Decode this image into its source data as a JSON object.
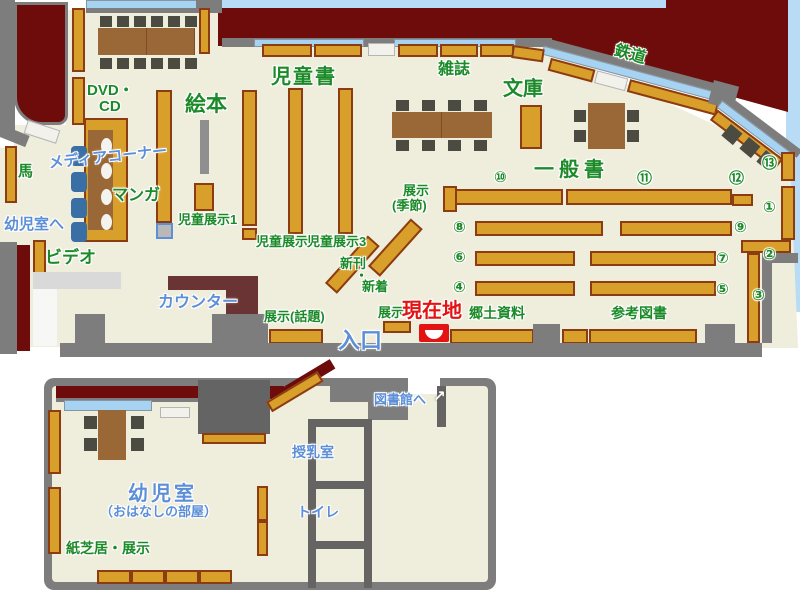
{
  "labels": {
    "dvd1": "DVD・",
    "dvd2": "CD",
    "ehon": "絵本",
    "jidosho": "児童書",
    "zasshi": "雑誌",
    "bunko": "文庫",
    "ippansho": "一般書",
    "tetsudo": "鉄道",
    "media_corner": "メディアコーナー",
    "manga": "マンガ",
    "uma": "馬",
    "yojishitsu_e": "幼児室へ",
    "video": "ビデオ",
    "counter": "カウンター",
    "jido_tenji1": "児童展示1",
    "jido_tenji2": "児童展示2",
    "jido_tenji3": "児童展示3",
    "tenji_kisetsu1": "展示",
    "tenji_kisetsu2": "(季節)",
    "shinkan": "新刊",
    "dot": "・",
    "shinchaku": "新着",
    "tenji_wadai": "展示(話題)",
    "tenji": "展示",
    "genzaichi": "現在地",
    "iriguchi": "入口",
    "kyodo_shiryo": "郷土資料",
    "sanko_tosho": "参考図書",
    "yojishitsu": "幼児室",
    "ohanashi": "（おはなしの部屋）",
    "kamishibai": "紙芝居・展示",
    "junyushitsu": "授乳室",
    "toire": "トイレ",
    "toshokan_e": "図書館へ",
    "arrow": "↗"
  },
  "numbers": {
    "n1": "①",
    "n2": "②",
    "n3": "③",
    "n4": "④",
    "n5": "⑤",
    "n6": "⑥",
    "n7": "⑦",
    "n8": "⑧",
    "n9": "⑨",
    "n10": "⑩",
    "n11": "⑪",
    "n12": "⑫",
    "n13": "⑬"
  },
  "colors": {
    "wall": "#7d7d7d",
    "outside": "#6e0b0b",
    "floor": "#efeddc",
    "shelf": "#d99f2b",
    "shelf_border": "#8c3c12",
    "table": "#9a6836",
    "chair": "#4c4b41",
    "window": "#a6d3f2",
    "sky": "#b9dcf6",
    "counter": "#6b3434",
    "label_green": "#1c8a28",
    "label_blue": "#5c8fd8",
    "label_red": "#e31313",
    "media_chair": "#3a6fa5",
    "marker_red": "#e31313"
  }
}
